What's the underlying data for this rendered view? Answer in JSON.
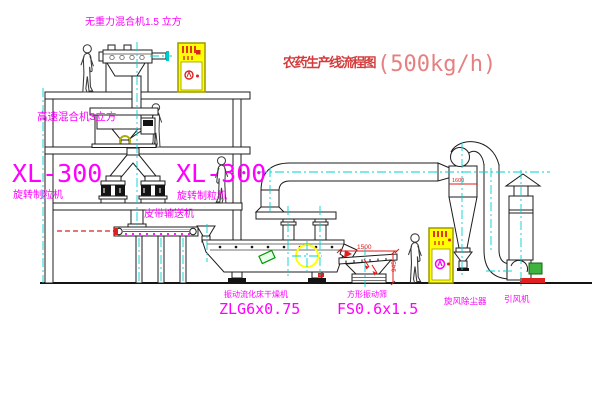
{
  "title": {
    "text_zh": "农药生产线流程图",
    "capacity": "(500kg/h)"
  },
  "equipment_labels": {
    "gravity_mixer": "无重力混合机1.5 立方",
    "high_speed_mixer": "高速混合机3立方",
    "granulator_left_model": "XL-300",
    "granulator_left_name": "旋转制粒机",
    "granulator_right_model": "XL-300",
    "granulator_right_name": "旋转制粒机",
    "belt_conveyor": "皮带输送机",
    "dryer_name": "振动流化床干燥机",
    "dryer_model": "ZLG6x0.75",
    "sieve_name": "方形振动筛",
    "sieve_model": "FS0.6x1.5",
    "cyclone_name": "旋风除尘器",
    "fan_name": "引风机"
  },
  "dimensions": {
    "sieve_length": "1500",
    "sieve_height": "945",
    "cyclone_level": "1600"
  },
  "colors": {
    "label_magenta": "#ff00ff",
    "title_red": "#d43c3c",
    "capacity_red": "#e68080",
    "centerline_cyan": "#00d2d2",
    "cabinet_yellow": "#ffff00",
    "dimension_red": "#e01818",
    "line_black": "#1c1c1c"
  }
}
